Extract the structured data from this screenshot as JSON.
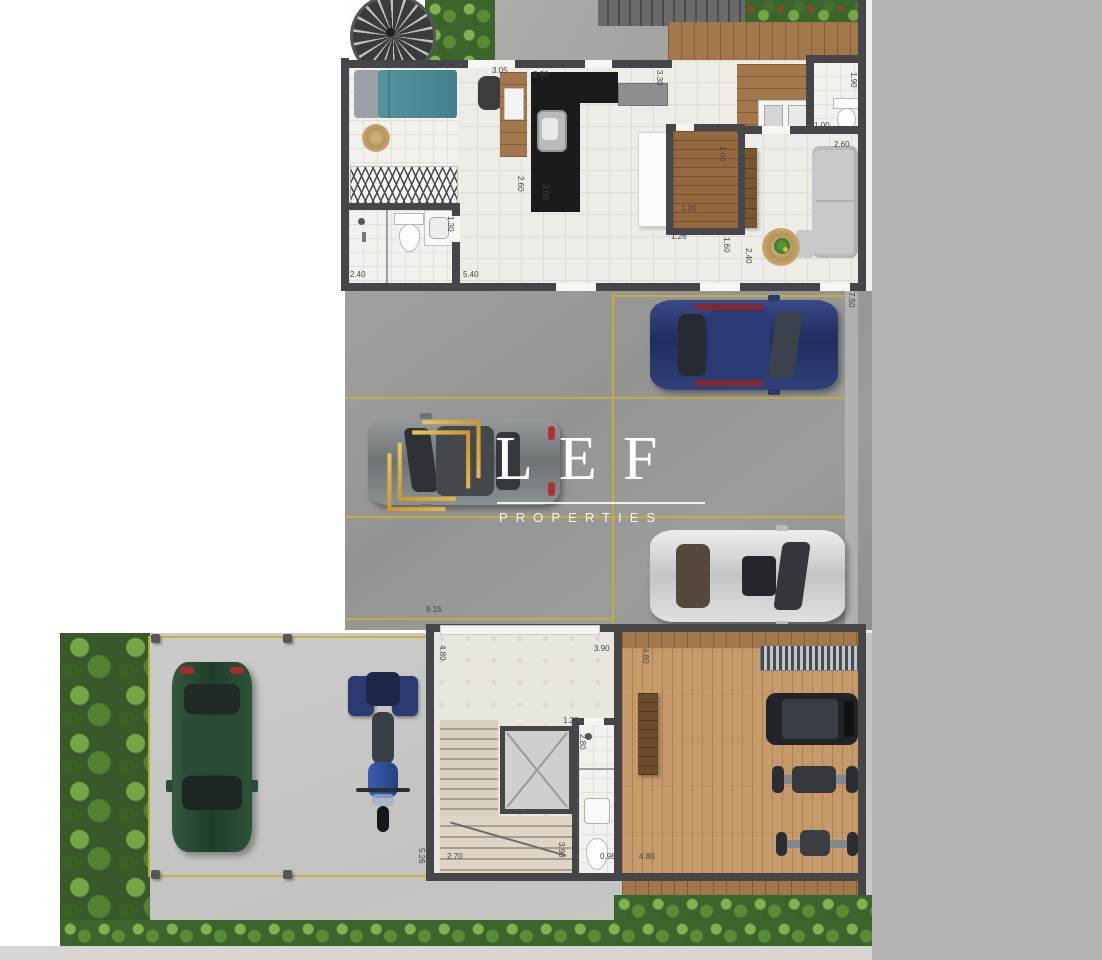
{
  "watermark": {
    "brand": "LEF",
    "tagline": "PROPERTIES",
    "gold": "#d2a544",
    "text_color": "#fdfdfd"
  },
  "plan": {
    "dimensions": [
      {
        "text": "3.05",
        "x": 492,
        "y": 67,
        "v": false
      },
      {
        "text": "2.90",
        "x": 533,
        "y": 71,
        "v": false
      },
      {
        "text": "3.30",
        "x": 655,
        "y": 70,
        "v": true
      },
      {
        "text": "1.90",
        "x": 849,
        "y": 72,
        "v": true
      },
      {
        "text": "1.00",
        "x": 814,
        "y": 122,
        "v": false
      },
      {
        "text": "2.60",
        "x": 834,
        "y": 141,
        "v": false
      },
      {
        "text": "1.60",
        "x": 718,
        "y": 146,
        "v": true
      },
      {
        "text": "2.60",
        "x": 516,
        "y": 176,
        "v": true
      },
      {
        "text": "3.00",
        "x": 541,
        "y": 184,
        "v": true
      },
      {
        "text": "1.30",
        "x": 446,
        "y": 216,
        "v": true
      },
      {
        "text": "1.05",
        "x": 681,
        "y": 205,
        "v": false
      },
      {
        "text": "1.26",
        "x": 671,
        "y": 233,
        "v": false
      },
      {
        "text": "1.60",
        "x": 722,
        "y": 237,
        "v": true
      },
      {
        "text": "2.40",
        "x": 350,
        "y": 271,
        "v": false
      },
      {
        "text": "5.40",
        "x": 463,
        "y": 271,
        "v": false
      },
      {
        "text": "2.40",
        "x": 744,
        "y": 248,
        "v": true
      },
      {
        "text": "7.50",
        "x": 847,
        "y": 292,
        "v": true
      },
      {
        "text": "9.15",
        "x": 426,
        "y": 606,
        "v": false
      },
      {
        "text": "4.80",
        "x": 438,
        "y": 645,
        "v": true
      },
      {
        "text": "3.90",
        "x": 594,
        "y": 645,
        "v": false
      },
      {
        "text": "4.80",
        "x": 641,
        "y": 648,
        "v": true
      },
      {
        "text": "1.20",
        "x": 563,
        "y": 717,
        "v": false
      },
      {
        "text": "1.80",
        "x": 612,
        "y": 706,
        "v": true
      },
      {
        "text": "2.80",
        "x": 578,
        "y": 734,
        "v": true
      },
      {
        "text": "2.70",
        "x": 447,
        "y": 853,
        "v": false
      },
      {
        "text": "3.90",
        "x": 557,
        "y": 842,
        "v": true
      },
      {
        "text": "0.98",
        "x": 600,
        "y": 853,
        "v": false
      },
      {
        "text": "4.80",
        "x": 639,
        "y": 853,
        "v": false
      },
      {
        "text": "5.26",
        "x": 417,
        "y": 848,
        "v": true
      }
    ]
  },
  "colors": {
    "wall": "#46464a",
    "parking_line": "#c9ae39",
    "street_strip": "#b4b4b6",
    "garage_floor": "#9a9a98",
    "court_floor": "#c8c8c6",
    "hedge_green": "#3c652e"
  }
}
